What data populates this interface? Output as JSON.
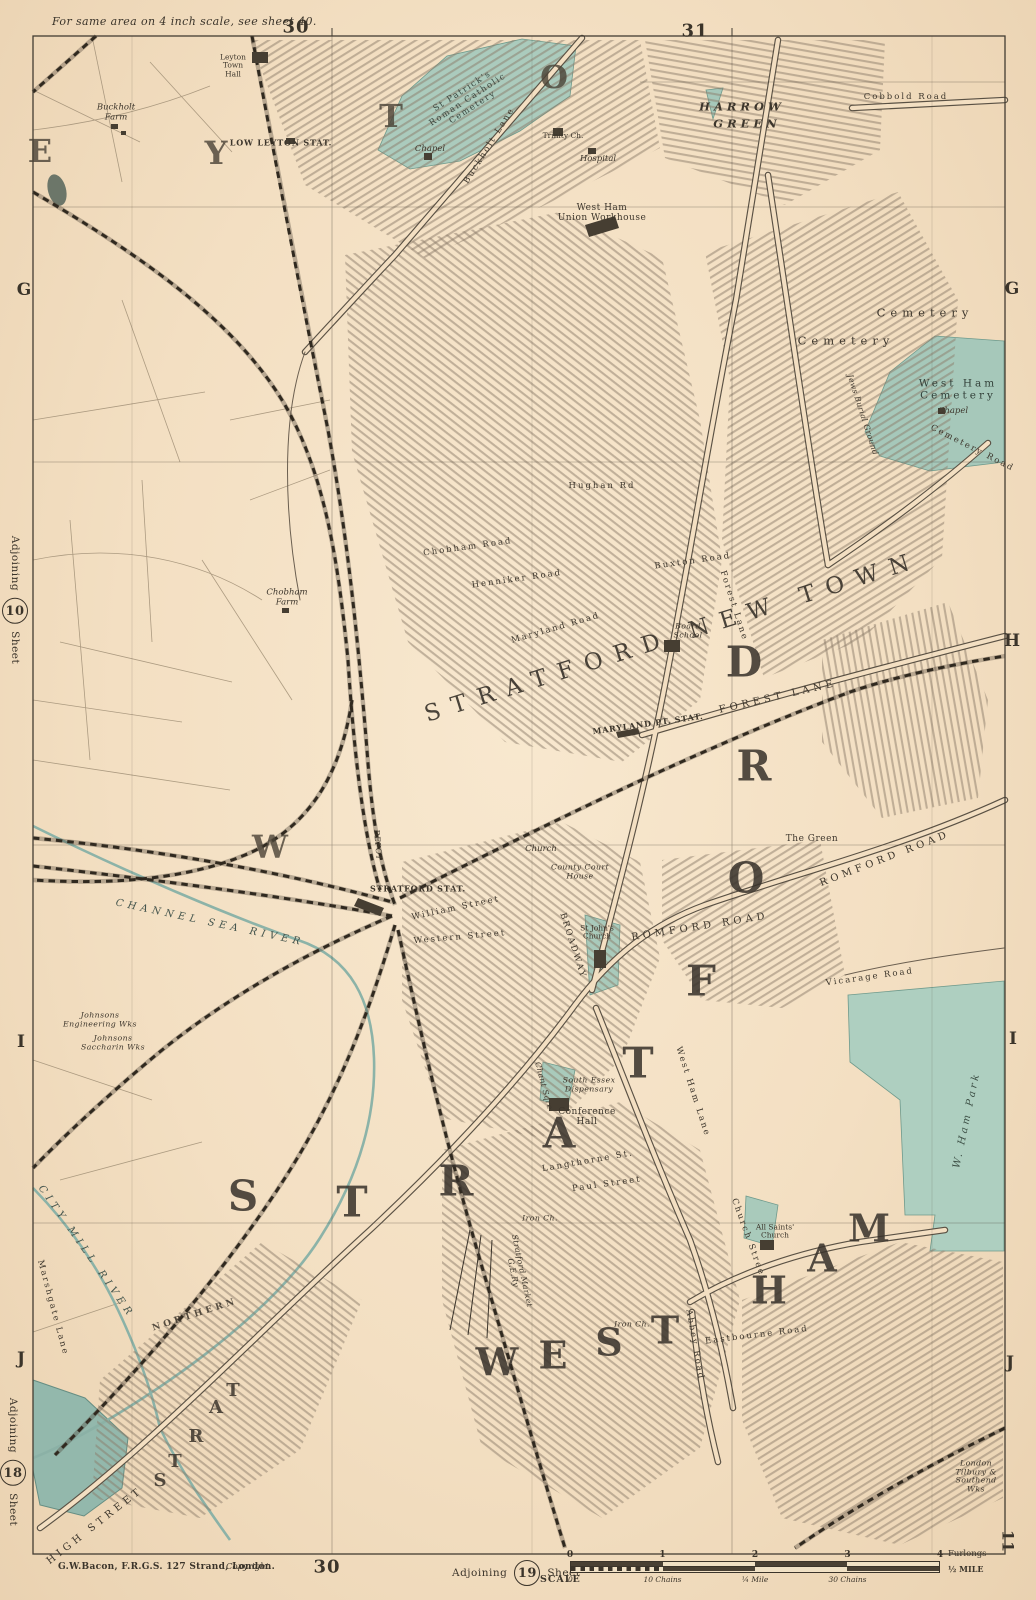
{
  "colors": {
    "paper": "#f3dfc2",
    "ink": "#3b342a",
    "hatch": "#81725f",
    "cemetery_green": "#abcbbd",
    "water_teal": "#8fb7ac",
    "railway_black": "#2f2922"
  },
  "margin": {
    "top_note": "For same area on 4 inch scale, see sheet 40.",
    "top_numbers": [
      {
        "t": "30",
        "x": 296,
        "y": 27
      },
      {
        "t": "31",
        "x": 695,
        "y": 31
      }
    ],
    "bottom_number": {
      "t": "30",
      "x": 327,
      "y": 1567
    },
    "imprint": "G.W.Bacon, F.R.G.S. 127 Strand, London.",
    "copyright": "Copyright",
    "adjoining_bottom": {
      "word": "Adjoining",
      "num": "19",
      "sheet": "Sheet",
      "scale": "SCALE"
    },
    "adjoining_left_top": {
      "word": "Adjoining",
      "num": "10",
      "sheet": "Sheet"
    },
    "adjoining_left_bottom": {
      "word": "Adjoining",
      "num": "18",
      "sheet": "Sheet"
    },
    "corner_number": "11",
    "scale_bar": {
      "furlongs": [
        "0",
        "1",
        "2",
        "3",
        "4"
      ],
      "furlongs_unit": "Furlongs",
      "chains": [
        "10 Chains",
        "¼ Mile",
        "30 Chains"
      ],
      "mile": "½ MILE",
      "zero": "0"
    }
  },
  "grid": {
    "letters": [
      {
        "t": "G",
        "x": 24,
        "y": 290
      },
      {
        "t": "I",
        "x": 21,
        "y": 1042
      },
      {
        "t": "J",
        "x": 21,
        "y": 1359
      },
      {
        "t": "G",
        "x": 1012,
        "y": 289
      },
      {
        "t": "H",
        "x": 1012,
        "y": 641
      },
      {
        "t": "I",
        "x": 1013,
        "y": 1039
      },
      {
        "t": "J",
        "x": 1010,
        "y": 1363
      }
    ]
  },
  "labels": [
    {
      "t": "E",
      "x": 40,
      "y": 152,
      "c": "g2"
    },
    {
      "t": "Y",
      "x": 216,
      "y": 154,
      "c": "g2"
    },
    {
      "t": "T",
      "x": 391,
      "y": 117,
      "c": "g2"
    },
    {
      "t": "O",
      "x": 554,
      "y": 78,
      "c": "g2"
    },
    {
      "t": "W",
      "x": 270,
      "y": 848,
      "c": "g2"
    },
    {
      "t": "S",
      "x": 243,
      "y": 1196,
      "c": "g1"
    },
    {
      "t": "T",
      "x": 352,
      "y": 1202,
      "c": "g1"
    },
    {
      "t": "R",
      "x": 456,
      "y": 1181,
      "c": "g1"
    },
    {
      "t": "A",
      "x": 559,
      "y": 1133,
      "c": "g1"
    },
    {
      "t": "T",
      "x": 638,
      "y": 1063,
      "c": "g1"
    },
    {
      "t": "F",
      "x": 701,
      "y": 981,
      "c": "g1"
    },
    {
      "t": "O",
      "x": 746,
      "y": 878,
      "c": "g1"
    },
    {
      "t": "R",
      "x": 754,
      "y": 766,
      "c": "g1"
    },
    {
      "t": "D",
      "x": 744,
      "y": 662,
      "c": "g1"
    },
    {
      "t": "W",
      "x": 497,
      "y": 1363,
      "c": "g1b"
    },
    {
      "t": "E",
      "x": 553,
      "y": 1356,
      "c": "g1b"
    },
    {
      "t": "S",
      "x": 609,
      "y": 1343,
      "c": "g1b"
    },
    {
      "t": "T",
      "x": 665,
      "y": 1331,
      "c": "g1b"
    },
    {
      "t": "H",
      "x": 769,
      "y": 1291,
      "c": "g1b"
    },
    {
      "t": "A",
      "x": 822,
      "y": 1259,
      "c": "g1b"
    },
    {
      "t": "M",
      "x": 869,
      "y": 1229,
      "c": "g1b"
    },
    {
      "t": "STRATFORD NEW TOWN",
      "x": 673,
      "y": 638,
      "r": -17.5,
      "c": "town"
    },
    {
      "t": "HARROW",
      "x": 742,
      "y": 107,
      "c": "dist"
    },
    {
      "t": "GREEN",
      "x": 747,
      "y": 124,
      "c": "dist"
    },
    {
      "t": "Leyton\nTown\nHall",
      "x": 233,
      "y": 66,
      "c": "tiny"
    },
    {
      "t": "LOW LEYTON STAT.",
      "x": 281,
      "y": 143,
      "c": "stat"
    },
    {
      "t": "Buckholt\nFarm",
      "x": 116,
      "y": 113,
      "c": "it"
    },
    {
      "t": "Buckholt Lane",
      "x": 490,
      "y": 146,
      "r": -58,
      "c": "road"
    },
    {
      "t": "St Patrick's\nRoman Catholic\nCemetery",
      "x": 468,
      "y": 100,
      "r": -33,
      "c": "cemsm"
    },
    {
      "t": "Chapel",
      "x": 430,
      "y": 150,
      "c": "it"
    },
    {
      "t": "Trinity Ch.",
      "x": 563,
      "y": 136,
      "c": "tiny"
    },
    {
      "t": "Hospital",
      "x": 598,
      "y": 160,
      "c": "it"
    },
    {
      "t": "West Ham\nUnion Workhouse",
      "x": 602,
      "y": 213,
      "c": "place"
    },
    {
      "t": "Cobbold Road",
      "x": 906,
      "y": 98,
      "c": "road"
    },
    {
      "t": "Cemetery",
      "x": 925,
      "y": 313,
      "c": "cem"
    },
    {
      "t": "Cemetery",
      "x": 846,
      "y": 341,
      "c": "cem"
    },
    {
      "t": "West Ham\nCemetery",
      "x": 958,
      "y": 390,
      "c": "cem2"
    },
    {
      "t": "Chapel",
      "x": 953,
      "y": 412,
      "c": "it"
    },
    {
      "t": "Jews Burial Ground",
      "x": 862,
      "y": 415,
      "r": 72,
      "c": "itsm"
    },
    {
      "t": "Cemetery Road",
      "x": 972,
      "y": 449,
      "r": 27,
      "c": "road"
    },
    {
      "t": "Chobham\nFarm",
      "x": 287,
      "y": 598,
      "c": "it"
    },
    {
      "t": "Chobham Road",
      "x": 468,
      "y": 548,
      "r": -8,
      "c": "road"
    },
    {
      "t": "Henniker Road",
      "x": 517,
      "y": 580,
      "r": -8,
      "c": "road"
    },
    {
      "t": "Maryland Road",
      "x": 556,
      "y": 629,
      "r": -16,
      "c": "road"
    },
    {
      "t": "Buxton Road",
      "x": 693,
      "y": 562,
      "r": -8,
      "c": "road"
    },
    {
      "t": "Forest Lane",
      "x": 733,
      "y": 606,
      "r": 72,
      "c": "road"
    },
    {
      "t": "Board\nSchool",
      "x": 688,
      "y": 631,
      "c": "itsm"
    },
    {
      "t": "MARYLAND PT. STAT.",
      "x": 648,
      "y": 724,
      "r": -8,
      "c": "stat"
    },
    {
      "t": "FOREST LANE",
      "x": 778,
      "y": 697,
      "r": -13,
      "c": "road2"
    },
    {
      "t": "Hughan Rd",
      "x": 602,
      "y": 487,
      "c": "road"
    },
    {
      "t": "ROMFORD ROAD",
      "x": 700,
      "y": 927,
      "r": -9,
      "c": "road2"
    },
    {
      "t": "ROMFORD ROAD",
      "x": 885,
      "y": 859,
      "r": -21,
      "c": "road2"
    },
    {
      "t": "The Green",
      "x": 812,
      "y": 839,
      "c": "place"
    },
    {
      "t": "BROADWAY",
      "x": 572,
      "y": 946,
      "r": 72,
      "c": "road"
    },
    {
      "t": "St John's\nChurch",
      "x": 597,
      "y": 933,
      "c": "tiny"
    },
    {
      "t": "County Court\nHouse",
      "x": 580,
      "y": 872,
      "c": "itsm"
    },
    {
      "t": "Conference\nHall",
      "x": 587,
      "y": 1117,
      "c": "place"
    },
    {
      "t": "South Essex\nDispensary",
      "x": 589,
      "y": 1085,
      "c": "itsm"
    },
    {
      "t": "Chant Sqre",
      "x": 543,
      "y": 1086,
      "r": 75,
      "c": "itsm"
    },
    {
      "t": "West Ham Lane",
      "x": 692,
      "y": 1092,
      "r": 72,
      "c": "road"
    },
    {
      "t": "Vicarage Road",
      "x": 870,
      "y": 978,
      "r": -8,
      "c": "road"
    },
    {
      "t": "W. Ham Park",
      "x": 967,
      "y": 1120,
      "r": -78,
      "c": "park"
    },
    {
      "t": "Eastbourne Road",
      "x": 757,
      "y": 1336,
      "r": -7,
      "c": "road"
    },
    {
      "t": "Abbey Road",
      "x": 694,
      "y": 1345,
      "r": 80,
      "c": "road"
    },
    {
      "t": "Church Street",
      "x": 748,
      "y": 1240,
      "r": 70,
      "c": "road"
    },
    {
      "t": "All Saints'\nChurch",
      "x": 775,
      "y": 1232,
      "c": "tiny"
    },
    {
      "t": "Paul Street",
      "x": 607,
      "y": 1185,
      "r": -8,
      "c": "road"
    },
    {
      "t": "Langthorne St.",
      "x": 588,
      "y": 1162,
      "r": -10,
      "c": "road"
    },
    {
      "t": "Stratford Market\nG.E.Ry",
      "x": 517,
      "y": 1272,
      "r": 78,
      "c": "itsm"
    },
    {
      "t": "Iron Ch.",
      "x": 540,
      "y": 1219,
      "c": "itsm"
    },
    {
      "t": "Iron Ch.",
      "x": 632,
      "y": 1325,
      "c": "itsm"
    },
    {
      "t": "CHANNEL SEA RIVER",
      "x": 210,
      "y": 923,
      "r": 12,
      "c": "water"
    },
    {
      "t": "CITY MILL RIVER",
      "x": 86,
      "y": 1252,
      "r": 55,
      "c": "water"
    },
    {
      "t": "Marshgate Lane",
      "x": 52,
      "y": 1308,
      "r": 75,
      "c": "road"
    },
    {
      "t": "NORTHERN",
      "x": 195,
      "y": 1315,
      "r": -18,
      "c": "rail"
    },
    {
      "t": "HIGH STREET",
      "x": 95,
      "y": 1526,
      "r": -38,
      "c": "road2"
    },
    {
      "t": "S",
      "x": 160,
      "y": 1481,
      "c": "g3"
    },
    {
      "t": "T",
      "x": 175,
      "y": 1462,
      "c": "g3"
    },
    {
      "t": "R",
      "x": 196,
      "y": 1437,
      "c": "g3"
    },
    {
      "t": "A",
      "x": 216,
      "y": 1408,
      "c": "g3"
    },
    {
      "t": "T",
      "x": 233,
      "y": 1391,
      "c": "g3"
    },
    {
      "t": "STRATFORD STAT.",
      "x": 418,
      "y": 889,
      "c": "stat"
    },
    {
      "t": "DEPOT",
      "x": 377,
      "y": 845,
      "r": 85,
      "c": "itsm"
    },
    {
      "t": "William Street",
      "x": 456,
      "y": 909,
      "r": -12,
      "c": "road"
    },
    {
      "t": "Western Street",
      "x": 460,
      "y": 938,
      "r": -5,
      "c": "road"
    },
    {
      "t": "Church",
      "x": 541,
      "y": 850,
      "c": "it"
    },
    {
      "t": "Johnsons\nEngineering Wks",
      "x": 100,
      "y": 1020,
      "c": "itsm"
    },
    {
      "t": "Johnsons\nSaccharin Wks",
      "x": 113,
      "y": 1043,
      "c": "itsm"
    },
    {
      "t": "London\nTilbury &\nSouthend\nWks",
      "x": 976,
      "y": 1477,
      "c": "itsm"
    }
  ]
}
